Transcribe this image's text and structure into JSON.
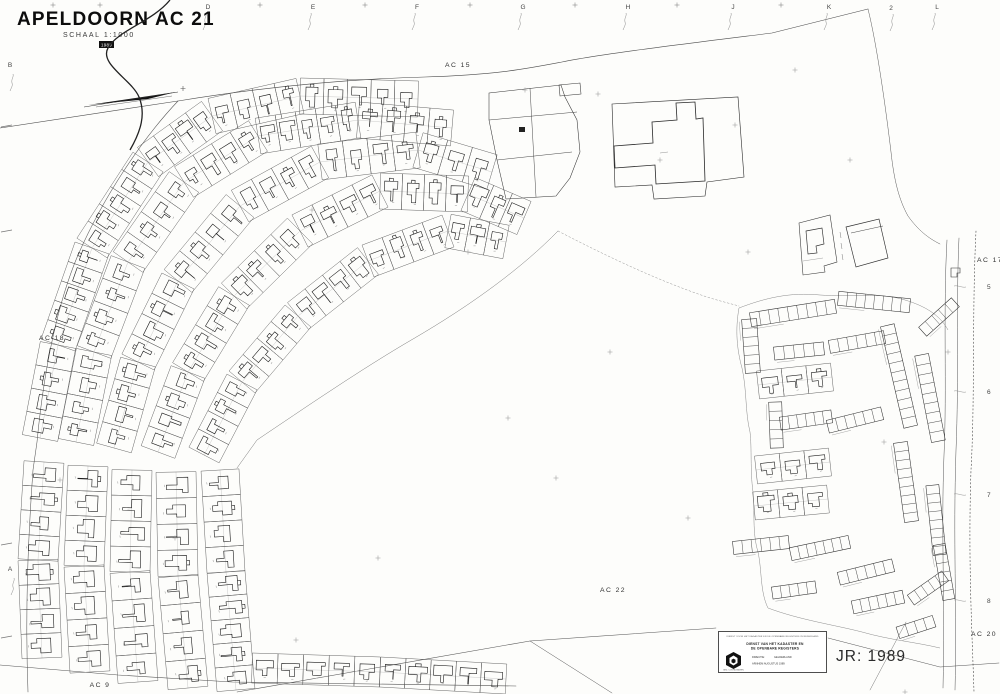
{
  "colors": {
    "paper": "#fdfdfb",
    "ink": "#1f1f1f",
    "faint_line": "#777777"
  },
  "title_block": {
    "title": "APELDOORN AC 21",
    "scale": "SCHAAL 1:1000",
    "year_stamp": "1989"
  },
  "grid": {
    "top_letters": [
      {
        "t": "D",
        "x": 208
      },
      {
        "t": "E",
        "x": 313
      },
      {
        "t": "F",
        "x": 417
      },
      {
        "t": "G",
        "x": 523
      },
      {
        "t": "H",
        "x": 628
      },
      {
        "t": "J",
        "x": 733
      },
      {
        "t": "K",
        "x": 829
      },
      {
        "t": "L",
        "x": 937
      }
    ],
    "top_tick_xs": [
      53,
      100,
      260,
      365,
      470,
      575,
      677,
      781
    ],
    "left_letters": [
      {
        "t": "B",
        "y": 67
      },
      {
        "t": "A",
        "y": 571
      }
    ],
    "right_numbers": [
      {
        "t": "5",
        "y": 289
      },
      {
        "t": "6",
        "y": 394
      },
      {
        "t": "7",
        "y": 497
      },
      {
        "t": "8",
        "y": 603
      }
    ],
    "stray_label": {
      "t": "2",
      "x": 891,
      "y": 10
    }
  },
  "region_labels": [
    {
      "t": "AC 15",
      "x": 458,
      "y": 67
    },
    {
      "t": "AC 18",
      "x": 52,
      "y": 340
    },
    {
      "t": "AC 17",
      "x": 990,
      "y": 262
    },
    {
      "t": "AC 20",
      "x": 984,
      "y": 636
    },
    {
      "t": "AC 22",
      "x": 613,
      "y": 592
    },
    {
      "t": "AC 9",
      "x": 100,
      "y": 687
    }
  ],
  "stamp": {
    "top_line": "DIENST VOOR HET KADASTER EN DE OPENBARE REGISTERS IN NEDERLAND",
    "line1": "DIENST VAN HET KADASTER EN",
    "line2": "DE OPENBARE REGISTERS",
    "dir_label": "DIRECTIE:",
    "dir_value": "GELDERLAND",
    "place_line": "ARNHEM   AUGUSTUS   1989",
    "foot_line": "GEZ. COORDINATEN"
  },
  "annotations": {
    "year_ref": "JR: 1989"
  }
}
